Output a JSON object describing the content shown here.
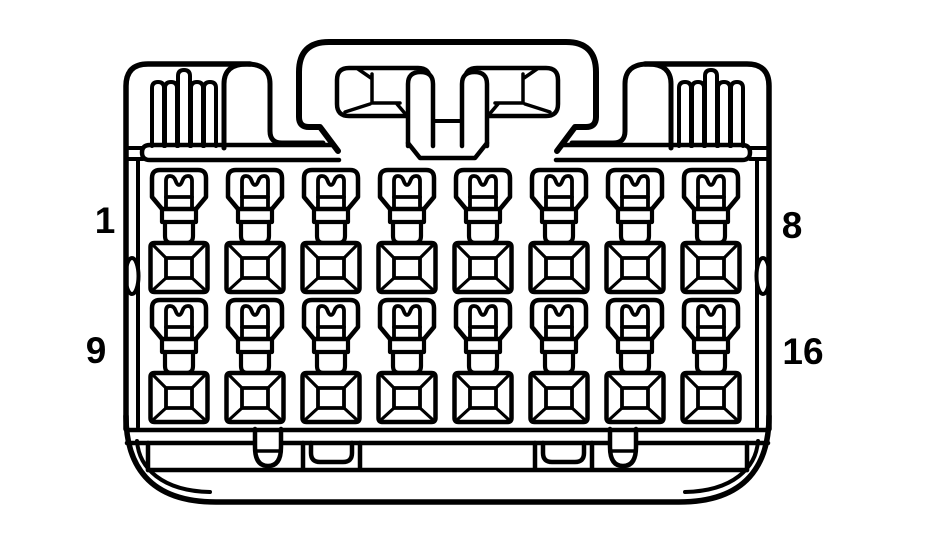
{
  "figure": {
    "type": "connector-face-diagram",
    "rows": 2,
    "columns": 8,
    "pin_labels": {
      "top_left": "1",
      "top_right": "8",
      "bottom_left": "9",
      "bottom_right": "16"
    },
    "colors": {
      "line": "#000000",
      "background": "#ffffff"
    }
  }
}
